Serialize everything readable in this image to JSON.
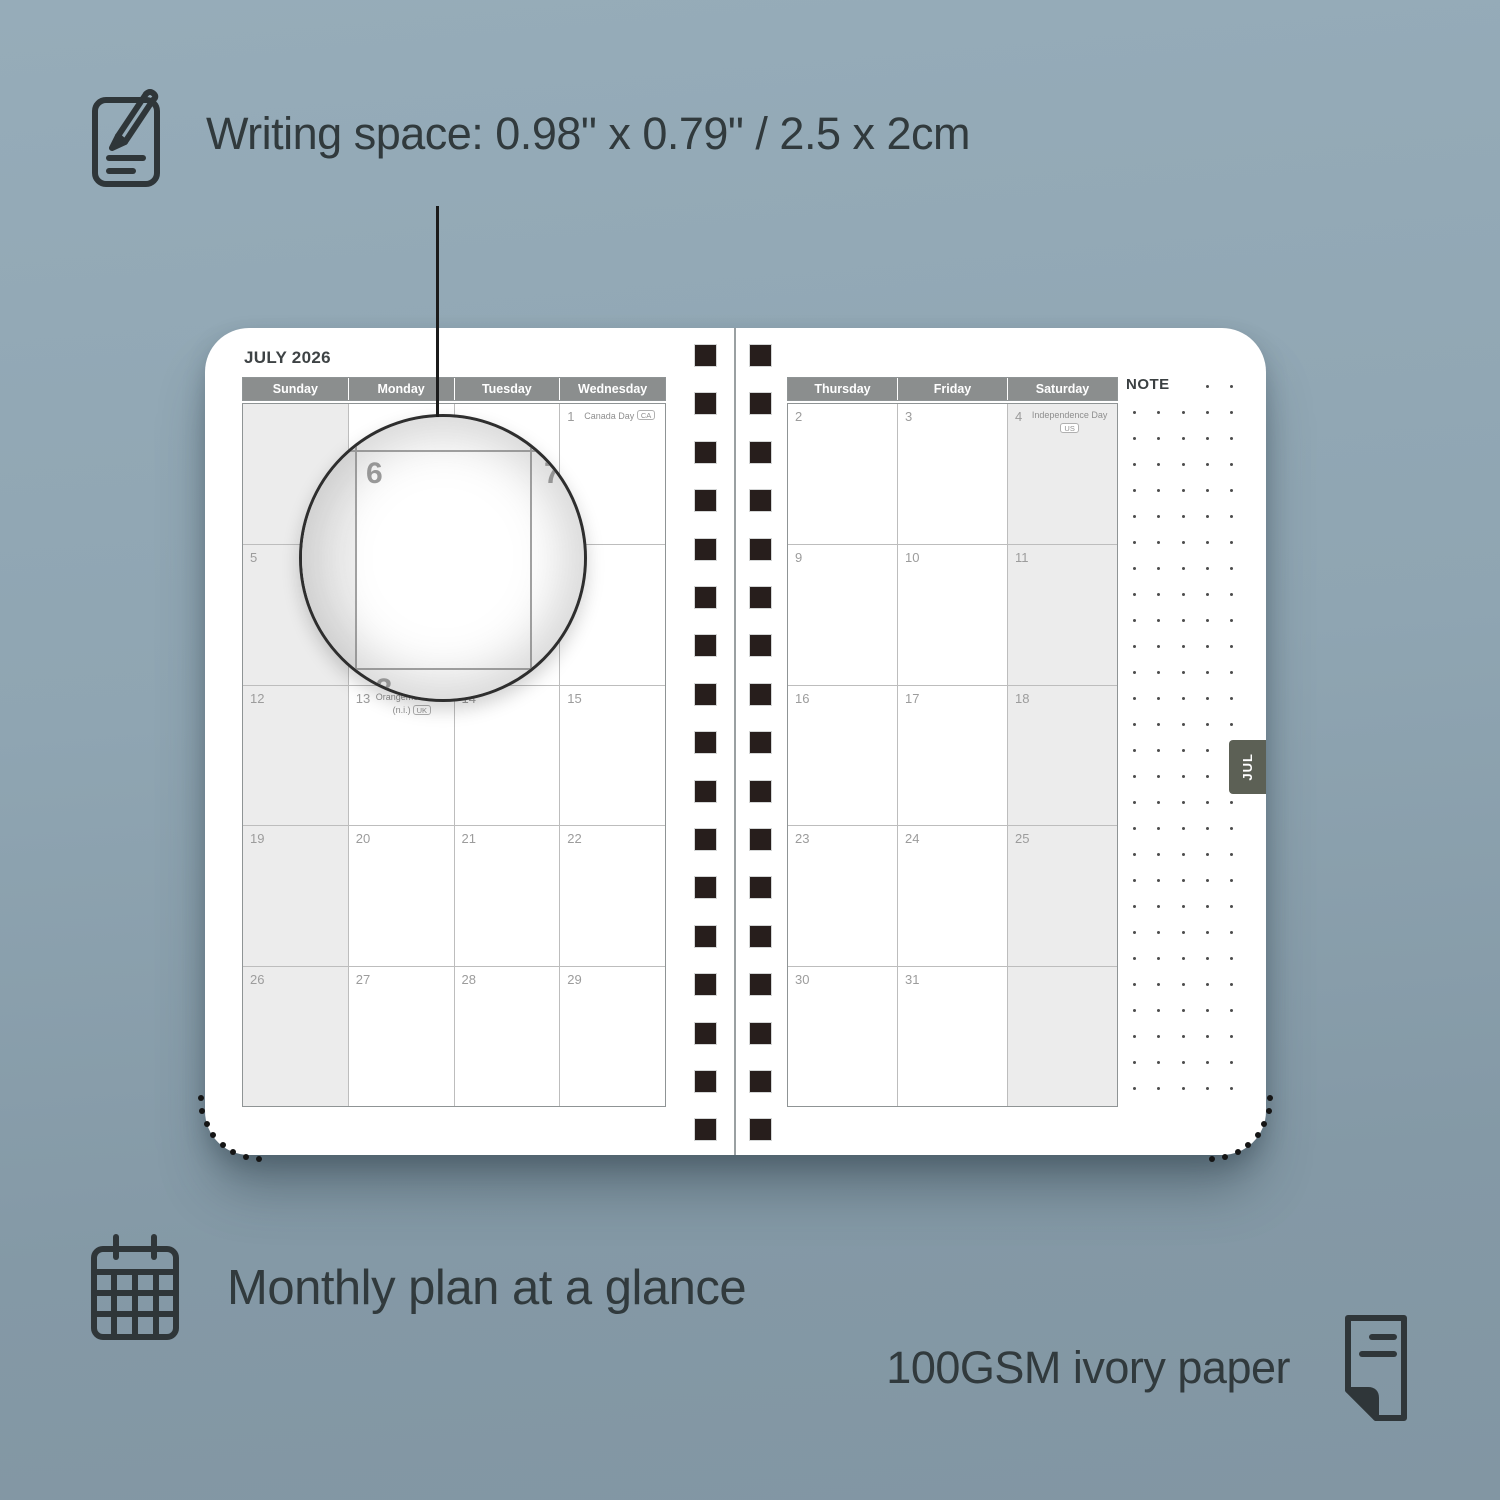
{
  "annotations": {
    "writing_space_label": "Writing space: 0.98\" x 0.79\" / 2.5 x 2cm",
    "monthly_plan_label": "Monthly plan at a glance",
    "paper_label": "100GSM ivory paper"
  },
  "planner": {
    "month_title": "JULY 2026",
    "note_label": "NOTE",
    "month_tab": "JUL",
    "left_page": {
      "day_headers": [
        "Sunday",
        "Monday",
        "Tuesday",
        "Wednesday"
      ],
      "weekend_col": 0,
      "rows": [
        [
          {
            "day": ""
          },
          {
            "day": ""
          },
          {
            "day": ""
          },
          {
            "day": "1",
            "holiday": "Canada Day",
            "badge": "CA",
            "badge_layout": "inline"
          }
        ],
        [
          {
            "day": "5"
          },
          {
            "day": "6"
          },
          {
            "day": "7"
          },
          {
            "day": "8"
          }
        ],
        [
          {
            "day": "12"
          },
          {
            "day": "13",
            "holiday": "Orangemen's Day",
            "holiday_note": "(n.i.)",
            "badge": "UK",
            "badge_layout": "below"
          },
          {
            "day": "14"
          },
          {
            "day": "15"
          }
        ],
        [
          {
            "day": "19"
          },
          {
            "day": "20"
          },
          {
            "day": "21"
          },
          {
            "day": "22"
          }
        ],
        [
          {
            "day": "26"
          },
          {
            "day": "27"
          },
          {
            "day": "28"
          },
          {
            "day": "29"
          }
        ]
      ]
    },
    "right_page": {
      "day_headers": [
        "Thursday",
        "Friday",
        "Saturday"
      ],
      "weekend_col": 2,
      "rows": [
        [
          {
            "day": "2"
          },
          {
            "day": "3"
          },
          {
            "day": "4",
            "holiday": "Independence Day",
            "badge": "US",
            "badge_layout": "below"
          }
        ],
        [
          {
            "day": "9"
          },
          {
            "day": "10"
          },
          {
            "day": "11"
          }
        ],
        [
          {
            "day": "16"
          },
          {
            "day": "17"
          },
          {
            "day": "18"
          }
        ],
        [
          {
            "day": "23"
          },
          {
            "day": "24"
          },
          {
            "day": "25"
          }
        ],
        [
          {
            "day": "30"
          },
          {
            "day": "31"
          },
          {
            "day": ""
          }
        ]
      ]
    },
    "lens": {
      "day_main": "6",
      "day_right": "7",
      "day_bottom": "13"
    }
  },
  "colors": {
    "background": "#8fa5b2",
    "header_gray": "#8b8e8e",
    "weekend_fill": "#ececec",
    "tab_fill": "#5c6055",
    "spiral_square": "#271e1c",
    "ink": "#313a3d"
  }
}
